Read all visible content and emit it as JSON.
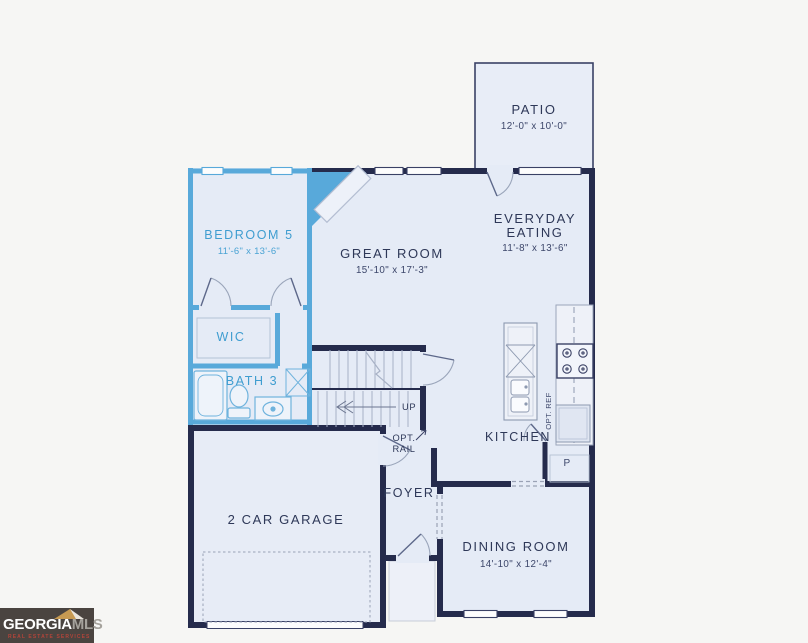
{
  "canvas": {
    "width": 808,
    "height": 643,
    "background": "#f6f6f4"
  },
  "palette": {
    "wall_navy": "#252b4c",
    "accent_blue": "#58a9da",
    "room_fill": "#e5ebf6",
    "stoop_fill": "#edf0f8",
    "fixture_stroke": "#8d99b0",
    "label_navy": "#2e3858",
    "label_blue": "#3f9dd0",
    "logo_background": "#4a4440",
    "logo_gold": "#c79a52"
  },
  "rooms": {
    "patio": {
      "name": "PATIO",
      "dims": "12'-0\" x 10'-0\""
    },
    "bedroom5": {
      "name": "BEDROOM 5",
      "dims": "11'-6\" x 13'-6\""
    },
    "great_room": {
      "name": "GREAT ROOM",
      "dims": "15'-10\" x 17'-3\""
    },
    "everyday_eating": {
      "name_line1": "EVERYDAY",
      "name_line2": "EATING",
      "dims": "11'-8\" x 13'-6\""
    },
    "wic": {
      "name": "WIC"
    },
    "bath3": {
      "name": "BATH 3"
    },
    "kitchen": {
      "name": "KITCHEN"
    },
    "pantry": {
      "name": "P"
    },
    "foyer": {
      "name": "FOYER"
    },
    "dining_room": {
      "name": "DINING ROOM",
      "dims": "14'-10\" x 12'-4\""
    },
    "garage": {
      "name": "2 CAR GARAGE"
    }
  },
  "annotations": {
    "stairs_up": "UP",
    "opt_rail_line1": "OPT.",
    "opt_rail_line2": "RAIL",
    "opt_ref": "OPT. REF"
  },
  "watermark": {
    "brand_part1": "GEORGIA",
    "brand_part2": "MLS",
    "tagline": "REAL ESTATE SERVICES"
  }
}
